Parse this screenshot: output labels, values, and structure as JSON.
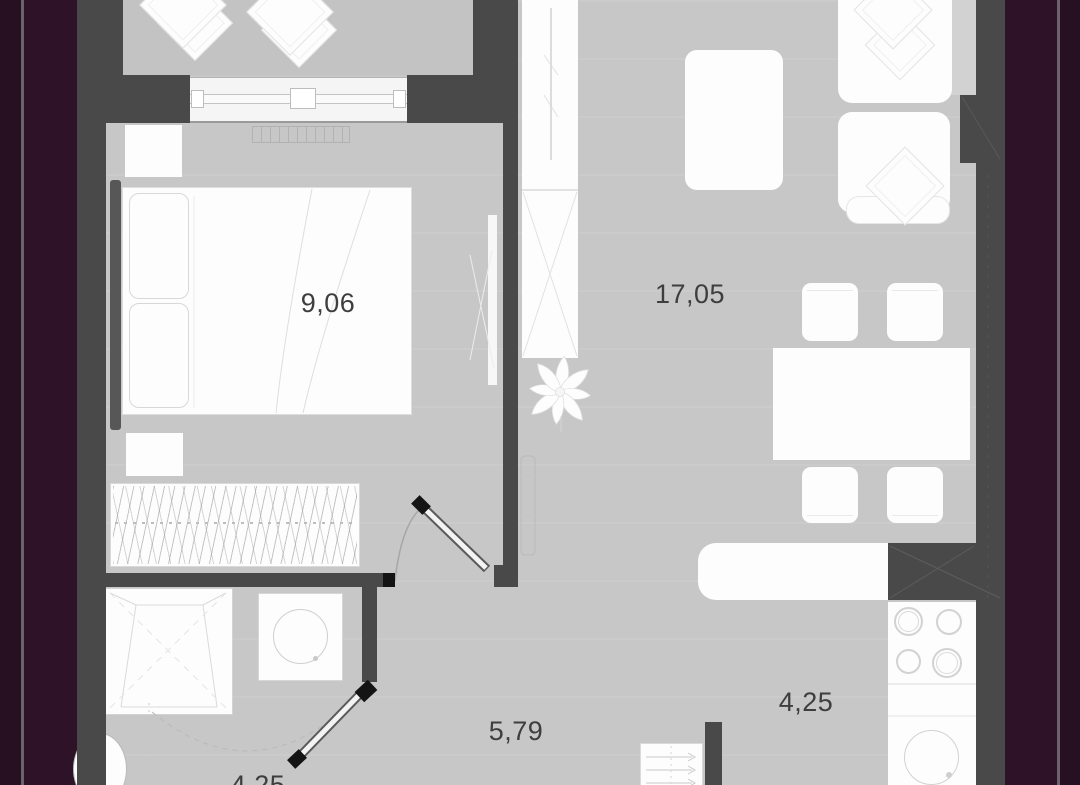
{
  "view": {
    "kind": "apartment-floor-plan",
    "frame": {
      "left_band": "dark-purple",
      "right_band": "dark-purple"
    }
  },
  "rooms": {
    "bedroom": {
      "name": "bedroom",
      "area": "9,06"
    },
    "living": {
      "name": "living-room",
      "area": "17,05"
    },
    "kitchen": {
      "name": "kitchen",
      "area": "4,25"
    },
    "hallway": {
      "name": "hallway",
      "area": "5,79"
    },
    "bathroom": {
      "name": "bathroom",
      "area": "4,25"
    }
  },
  "furniture": [
    "balcony-cushions",
    "window",
    "bedroom-radiator",
    "double-bed",
    "pillows",
    "nightstands",
    "headboard-panel",
    "wardrobe-with-hangers",
    "mirror",
    "hall-closet",
    "plant",
    "hall-radiator",
    "tv-stand",
    "sofa",
    "sofa-cushions",
    "dining-table",
    "chairs",
    "kitchen-counter",
    "ventilation-shaft",
    "stove",
    "kitchen-sink",
    "entry-shoe-rack",
    "shower",
    "washing-machine",
    "toilet",
    "door-swings"
  ],
  "colors": {
    "frame_purple": "#2e1328",
    "frame_purple_dark": "#281023",
    "frame_line": "#6e616e",
    "wall": "#494949",
    "floor": "#c7c7c7",
    "balcony_floor": "#c3c3c3",
    "furniture_fill": "#fdfdfd",
    "furniture_outline": "#dcdcdc",
    "label_text": "#3e3e3e",
    "door_cap": "#141414"
  }
}
